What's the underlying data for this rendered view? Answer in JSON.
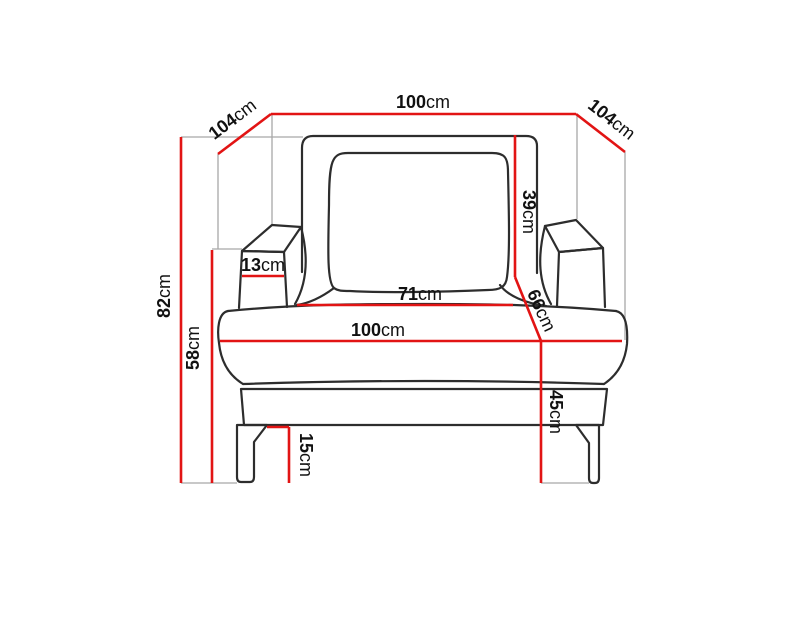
{
  "diagram": {
    "subject": "armchair-front-view-dimension-diagram",
    "unit": "cm"
  },
  "colors": {
    "dimension_line": "#e21414",
    "guide_line": "#a8a8a8",
    "chair_outline": "#2d2d2d",
    "label_text": "#111111",
    "background": "#ffffff"
  },
  "dimensions": [
    {
      "name": "overall-width-top",
      "value": "100",
      "unit": "cm"
    },
    {
      "name": "depth-left",
      "value": "104",
      "unit": "cm"
    },
    {
      "name": "depth-right",
      "value": "104",
      "unit": "cm"
    },
    {
      "name": "overall-height",
      "value": "82",
      "unit": "cm"
    },
    {
      "name": "armrest-height",
      "value": "58",
      "unit": "cm"
    },
    {
      "name": "armrest-width",
      "value": "13",
      "unit": "cm"
    },
    {
      "name": "backrest-cushion-height",
      "value": "39",
      "unit": "cm"
    },
    {
      "name": "seat-depth",
      "value": "66",
      "unit": "cm"
    },
    {
      "name": "seat-width-between-armrests",
      "value": "71",
      "unit": "cm"
    },
    {
      "name": "seat-width",
      "value": "100",
      "unit": "cm"
    },
    {
      "name": "seat-height",
      "value": "45",
      "unit": "cm"
    },
    {
      "name": "leg-height",
      "value": "15",
      "unit": "cm"
    }
  ]
}
